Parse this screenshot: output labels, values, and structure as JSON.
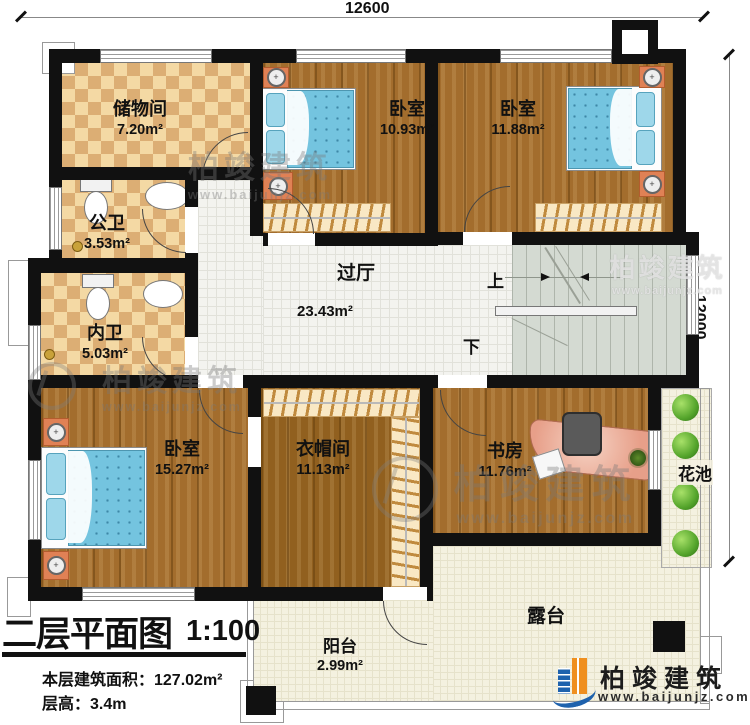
{
  "dims": {
    "top": "12600",
    "right": "12000"
  },
  "rooms": {
    "storage": {
      "name": "储物间",
      "area": "7.20m²"
    },
    "public_bath": {
      "name": "公卫",
      "area": "3.53m²"
    },
    "inner_bath": {
      "name": "内卫",
      "area": "5.03m²"
    },
    "bedroom_a": {
      "name": "卧室",
      "area": "10.93m²"
    },
    "bedroom_b": {
      "name": "卧室",
      "area": "11.88m²"
    },
    "hall": {
      "name": "过厅",
      "area": "23.43m²"
    },
    "bedroom_c": {
      "name": "卧室",
      "area": "15.27m²"
    },
    "cloakroom": {
      "name": "衣帽间",
      "area": "11.13m²"
    },
    "study": {
      "name": "书房",
      "area": "11.76m²"
    },
    "flower_bed": {
      "name": "花池"
    },
    "terrace": {
      "name": "露台"
    },
    "balcony": {
      "name": "阳台",
      "area": "2.99m²"
    }
  },
  "stairs": {
    "up": "上",
    "down": "下"
  },
  "title": {
    "main": "二层平面图",
    "scale": "1:100",
    "area_line": "本层建筑面积：127.02m²",
    "height_line": "层高：3.4m"
  },
  "brand": {
    "name": "柏竣建筑",
    "url": "www.baijunjz.com"
  },
  "colors": {
    "wall": "#111111",
    "wood_floor": "#a36d2d",
    "tile_check_light": "#f4d9a4",
    "tile_check_dark": "#dcae74",
    "hall_tile": "#f3f3ef",
    "terrace": "#f4f1e0",
    "stairs": "#d4dad2",
    "bed": "#74c4df",
    "nightstand": "#e08155",
    "desk": "#e79f89",
    "bush": "#55a52c",
    "logo_blue": "#1e62ad",
    "logo_orange": "#ef8f1f"
  }
}
